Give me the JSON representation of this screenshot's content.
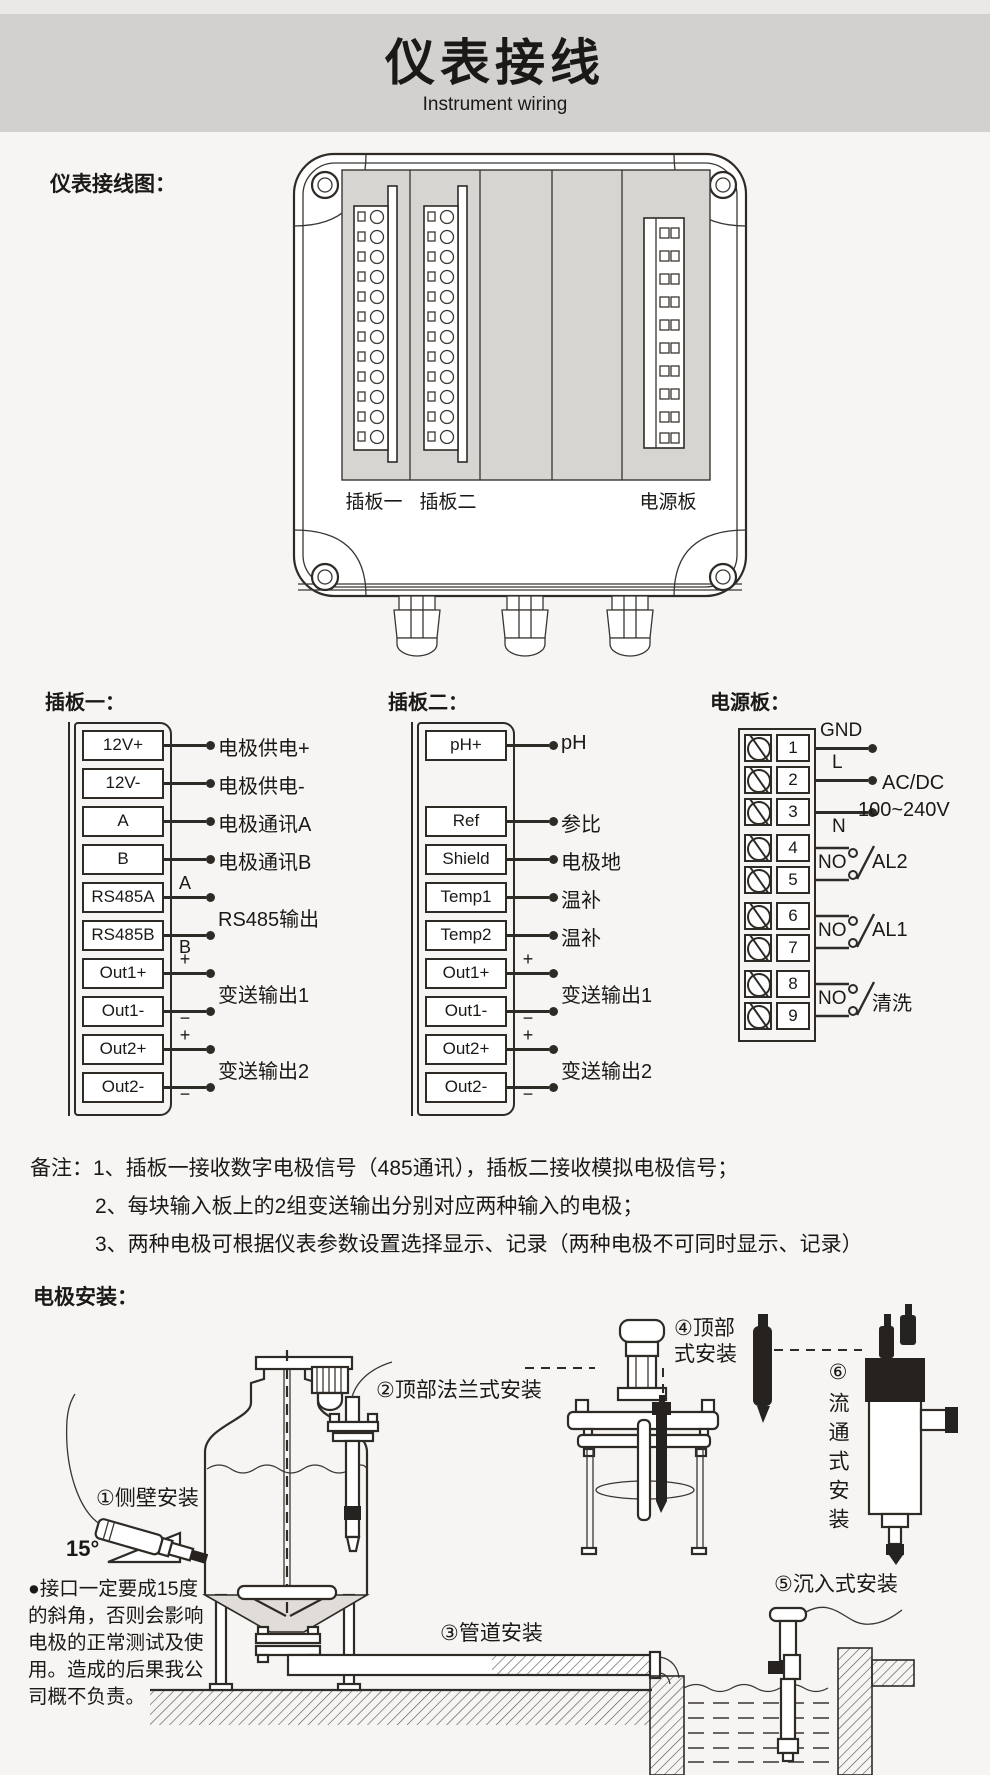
{
  "header": {
    "title": "仪表接线",
    "subtitle": "Instrument wiring"
  },
  "diagram": {
    "section_label": "仪表接线图：",
    "slot1_label": "插板一",
    "slot2_label": "插板二",
    "power_label": "电源板"
  },
  "board1": {
    "title": "插板一：",
    "terminals": [
      "12V+",
      "12V-",
      "A",
      "B",
      "RS485A",
      "RS485B",
      "Out1+",
      "Out1-",
      "Out2+",
      "Out2-"
    ],
    "labels": {
      "supply_pos": "电极供电+",
      "supply_neg": "电极供电-",
      "comm_a": "电极通讯A",
      "comm_b": "电极通讯B",
      "rs485": "RS485输出",
      "out1": "变送输出1",
      "out2": "变送输出2"
    },
    "marks": {
      "a": "A",
      "b": "B",
      "plus": "+",
      "minus": "−"
    }
  },
  "board2": {
    "title": "插板二：",
    "terminals": [
      "pH+",
      "Ref",
      "Shield",
      "Temp1",
      "Temp2",
      "Out1+",
      "Out1-",
      "Out2+",
      "Out2-"
    ],
    "labels": {
      "ph": "pH",
      "ref": "参比",
      "shield": "电极地",
      "temp1": "温补",
      "temp2": "温补",
      "out1": "变送输出1",
      "out2": "变送输出2"
    },
    "marks": {
      "plus": "+",
      "minus": "−"
    }
  },
  "power": {
    "title": "电源板：",
    "terminals": [
      "1",
      "2",
      "3",
      "4",
      "5",
      "6",
      "7",
      "8",
      "9"
    ],
    "labels": {
      "gnd": "GND",
      "l": "L",
      "n": "N",
      "acdc1": "AC/DC",
      "acdc2": "100~240V",
      "no1": "NO",
      "no2": "NO",
      "no3": "NO",
      "al2": "AL2",
      "al1": "AL1",
      "wash": "清洗"
    }
  },
  "notes": {
    "prefix": "备注：",
    "items": [
      "1、插板一接收数字电极信号（485通讯），插板二接收模拟电极信号；",
      "2、每块输入板上的2组变送输出分别对应两种输入的电极；",
      "3、两种电极可根据仪表参数设置选择显示、记录（两种电极不可同时显示、记录）"
    ]
  },
  "install": {
    "section_label": "电极安装：",
    "label1": "①侧壁安装",
    "angle": "15°",
    "label2": "②顶部法兰式安装",
    "label3": "③管道安装",
    "label4": "④顶部\n式安装",
    "label5": "⑤沉入式安装",
    "label6": "⑥流通式安装",
    "warning": "●接口一定要成15度\n的斜角，否则会影响\n电极的正常测试及使\n用。造成的后果我公\n司概不负责。"
  }
}
